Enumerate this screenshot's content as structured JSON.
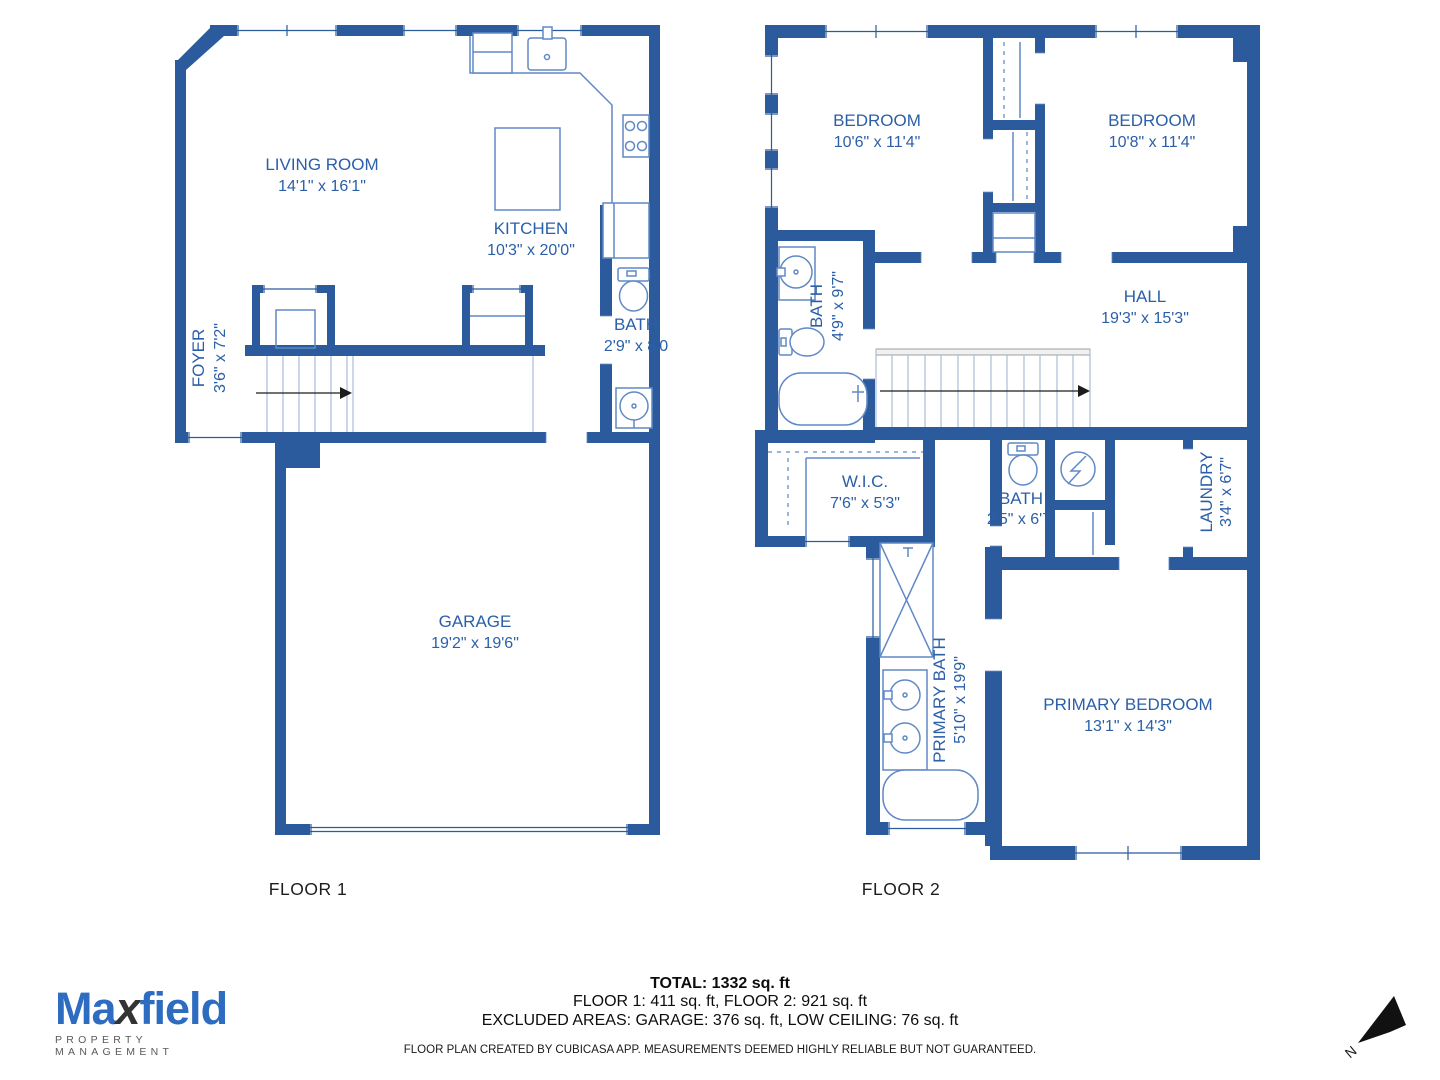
{
  "floor1": {
    "label": "FLOOR 1",
    "rooms": {
      "living_room": {
        "name": "LIVING ROOM",
        "dims": "14'1\" x 16'1\""
      },
      "kitchen": {
        "name": "KITCHEN",
        "dims": "10'3\" x 20'0\""
      },
      "bath": {
        "name": "BATH",
        "dims": "2'9\" x 8'0"
      },
      "foyer": {
        "name": "FOYER",
        "dims": "3'6\" x 7'2\""
      },
      "garage": {
        "name": "GARAGE",
        "dims": "19'2\" x 19'6\""
      }
    }
  },
  "floor2": {
    "label": "FLOOR 2",
    "rooms": {
      "bedroom_left": {
        "name": "BEDROOM",
        "dims": "10'6\" x 11'4\""
      },
      "bedroom_right": {
        "name": "BEDROOM",
        "dims": "10'8\" x 11'4\""
      },
      "bath_upper": {
        "name": "BATH",
        "dims": "4'9\" x 9'7\""
      },
      "hall": {
        "name": "HALL",
        "dims": "19'3\" x 15'3\""
      },
      "wic": {
        "name": "W.I.C.",
        "dims": "7'6\" x 5'3\""
      },
      "bath_small": {
        "name": "BATH",
        "dims": "2'5\" x 6'7"
      },
      "laundry": {
        "name": "LAUNDRY",
        "dims": "3'4\" x 6'7\""
      },
      "primary_bath": {
        "name": "PRIMARY BATH",
        "dims": "5'10\" x 19'9\""
      },
      "primary_bedroom": {
        "name": "PRIMARY BEDROOM",
        "dims": "13'1\" x 14'3\""
      }
    }
  },
  "footer": {
    "total": "TOTAL: 1332 sq. ft",
    "floors": "FLOOR 1: 411 sq. ft, FLOOR 2: 921 sq. ft",
    "excluded": "EXCLUDED AREAS: GARAGE: 376 sq. ft, LOW CEILING: 76 sq. ft",
    "disclaimer": "FLOOR PLAN CREATED BY CUBICASA APP. MEASUREMENTS DEEMED HIGHLY RELIABLE BUT NOT GUARANTEED."
  },
  "logo": {
    "brand_part1": "Ma",
    "brand_part2": "x",
    "brand_part3": "field",
    "tagline": "PROPERTY MANAGEMENT"
  },
  "compass": {
    "north": "N"
  },
  "colors": {
    "wall": "#2b5b9d",
    "fixture_outline": "#6089c6",
    "room_label": "#2b5fa8",
    "floor_label": "#1d1d1d",
    "stair_line": "#a9bcd9"
  }
}
